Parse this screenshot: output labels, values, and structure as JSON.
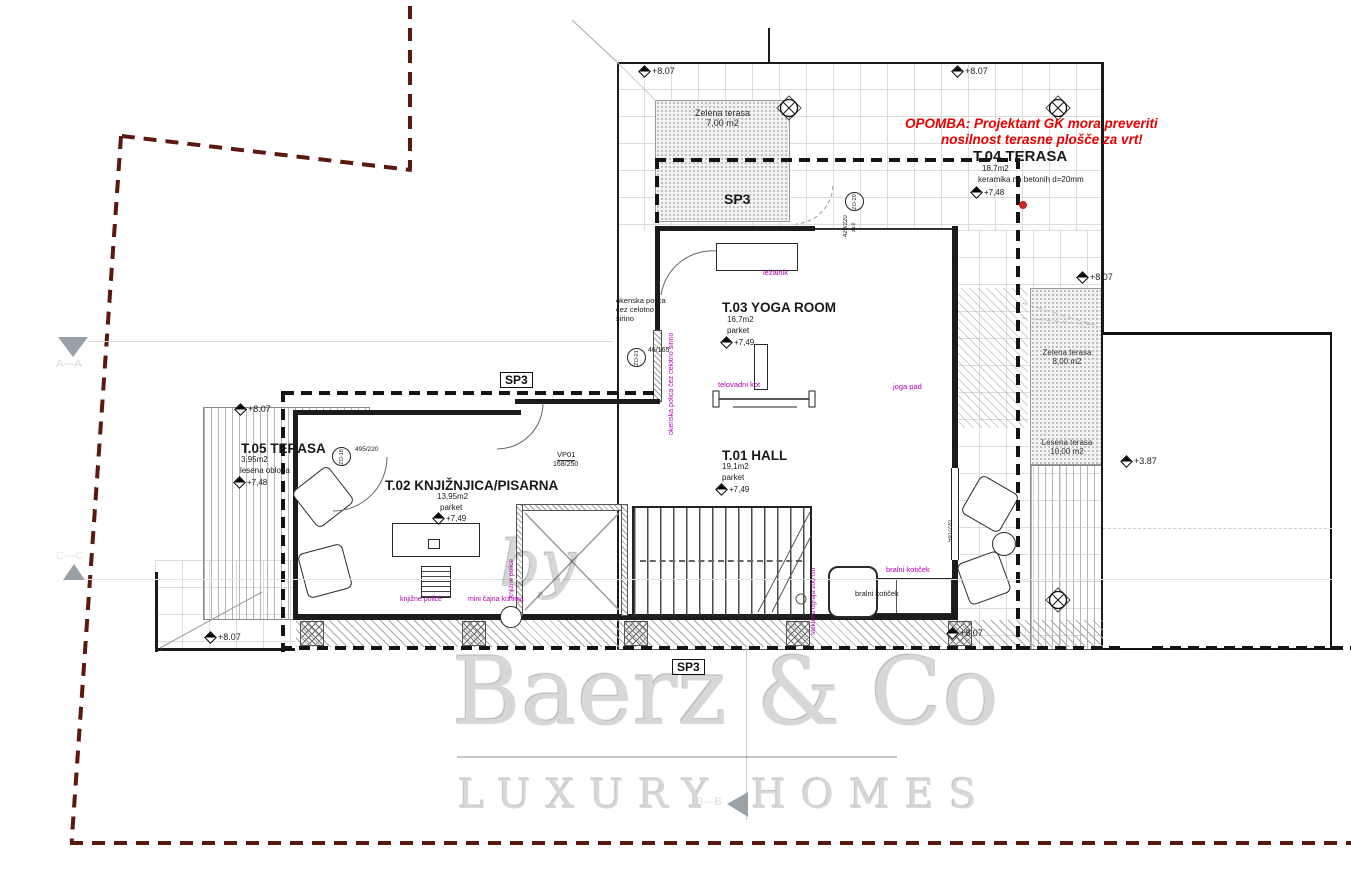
{
  "colors": {
    "boundary": "#5c170f",
    "wall": "#1c1c1c",
    "grid_line": "#dcdcdc",
    "annotation_purple": "#b400b4",
    "note_red": "#e60000",
    "watermark_gray": "#d7d7d7"
  },
  "note": {
    "line1": "OPOMBA: Projektant GK mora preveriti",
    "line2": "nosilnost terasne plošče za vrt!"
  },
  "rooms": {
    "t04": {
      "title": "T.04 TERASA",
      "area": "18,7m2",
      "finish": "keramika na betonih d=20mm",
      "elev": "+7,48"
    },
    "t03": {
      "title": "T.03 YOGA ROOM",
      "area": "16,7m2",
      "finish": "parket",
      "elev": "+7,49"
    },
    "t01": {
      "title": "T.01 HALL",
      "area": "19,1m2",
      "finish": "parket",
      "elev": "+7,49"
    },
    "t02": {
      "title": "T.02 KNJIŽNJICA/PISARNA",
      "area": "13,95m2",
      "finish": "parket",
      "elev": "+7,49"
    },
    "t05": {
      "title": "T.05 TERASA",
      "area": "3,95m2",
      "finish": "lesena obloga",
      "elev": "+7,48"
    }
  },
  "terraces": {
    "zelena7": {
      "name": "Zelena terasa",
      "area": "7,00 m2"
    },
    "zelena8": {
      "name": "Zelena terasa",
      "area": "8,00 m2"
    },
    "lesena10": {
      "name": "Lesena terasa",
      "area": "10,00 m2"
    }
  },
  "markers": {
    "sp3": "SP3",
    "e807": "+8.07",
    "e387": "+3.87"
  },
  "sections": {
    "aa": "A—A",
    "cc": "C—C",
    "bb": "B—B"
  },
  "labels": {
    "lezalnik": "ležalnik",
    "telovadni_kot": "telovadni kot",
    "joga_pad": "joga pad",
    "bralni_kot": "bralni kotiček",
    "knjizne_police": "knjižne police",
    "mini_kuhinja": "mini čajna kuhinja",
    "okenska_l1": "okenska polica",
    "okenska_l2": "čez celotno",
    "okenska_l3": "širino",
    "okenska_full": "okenska polica čez celotno širino",
    "ograja": "steklena ograja 100 cm",
    "vp01": "VP01",
    "vp01_size": "168/250",
    "d46": "46/165",
    "d420": "420/220",
    "d420_sub": "za:0",
    "d495": "495/220",
    "d591": "591/220",
    "zo18": "ZO-18",
    "zo20": "ZO-20",
    "zo21": "ZO-21"
  },
  "watermark": {
    "by": "by",
    "brand": "Baerz & Co",
    "tagline": "LUXURY HOMES"
  }
}
